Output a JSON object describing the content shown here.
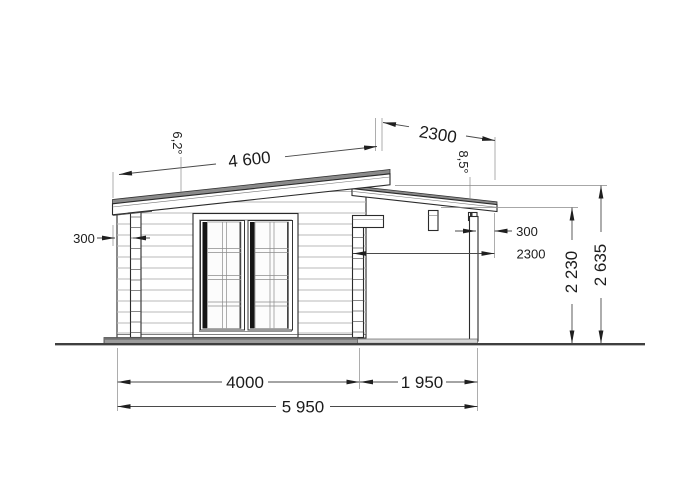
{
  "drawing": {
    "annotations": {
      "roof_length": "4 600",
      "roof_angle": "6,2°",
      "canopy_roof_length": "2300",
      "canopy_roof_angle": "8,5°",
      "left_roof_overhang": "300",
      "right_roof_overhang": "300",
      "canopy_depth": "2300",
      "height_canopy_eaves": "2 230",
      "height_ridge": "2 635",
      "width_cabin": "4000",
      "width_terrace": "1 950",
      "width_total": "5 950"
    },
    "colors": {
      "roof_top": "#8a8a8a",
      "foundation": "#9c9c9c",
      "foundation_edge": "#6f6f6f",
      "deck": "#d6d6d6",
      "outline": "#2b2b2b"
    }
  }
}
